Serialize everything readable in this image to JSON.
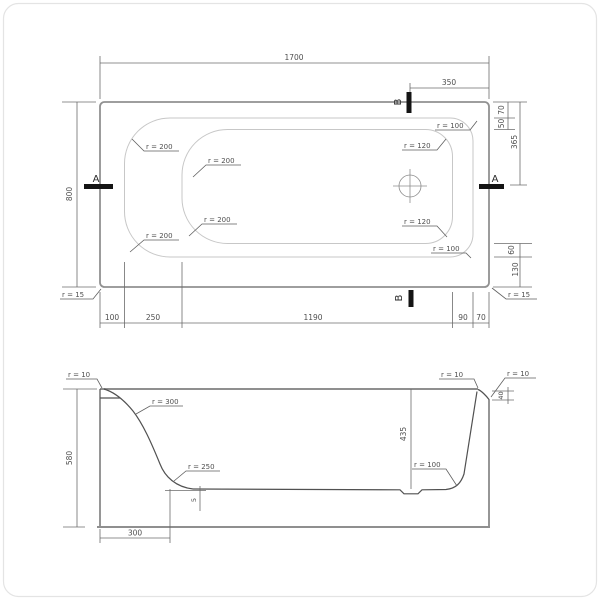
{
  "plan_view": {
    "overall_width": "1700",
    "overall_depth": "800",
    "section_b_offset": "350",
    "top_right": {
      "gap_70": "70",
      "gap_50": "50",
      "drain_365": "365"
    },
    "bottom_right": {
      "gap_60": "60",
      "gap_130": "130"
    },
    "bottom_dims": {
      "s1": "100",
      "s2": "250",
      "s3": "1190",
      "s4": "90",
      "s5": "70"
    },
    "radii": {
      "outer_top_left": "r = 200",
      "inner_top_left": "r = 200",
      "outer_top_right": "r = 100",
      "inner_top_right": "r = 120",
      "inner_bottom_right": "r = 120",
      "outer_bottom_right": "r = 100",
      "inner_bottom_left": "r = 200",
      "outer_bottom_left": "r = 200",
      "rim_corner_left": "r = 15",
      "rim_corner_right": "r = 15"
    },
    "markers": {
      "a": "A",
      "b": "B"
    }
  },
  "section_view": {
    "overall_height": "580",
    "inner_depth": "435",
    "rim_step": "40",
    "floor_drop": "5",
    "flat_floor_offset": "300",
    "radii": {
      "top_left": "r = 10",
      "wall_top": "r = 300",
      "wall_bottom": "r = 250",
      "floor_right": "r = 100",
      "top_right_inner": "r = 10",
      "top_right_outer": "r = 10"
    }
  }
}
